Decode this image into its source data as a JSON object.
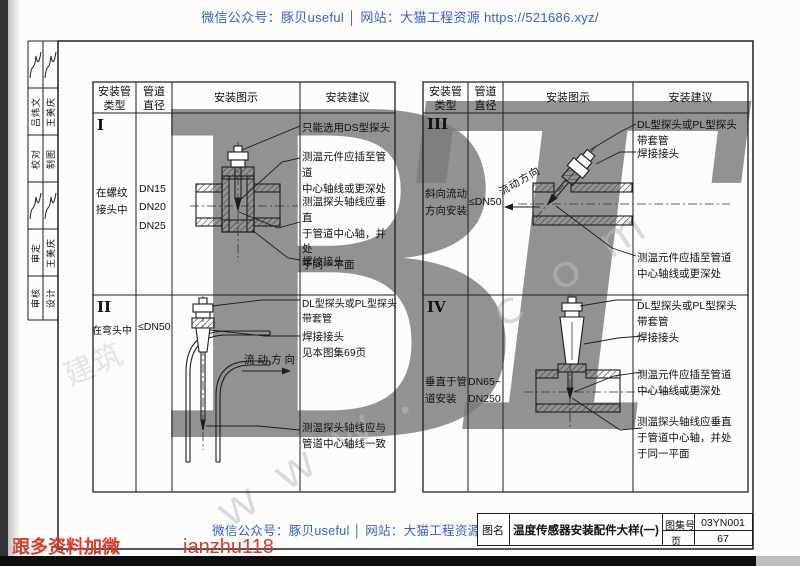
{
  "banners": {
    "top": "微信公众号：豚贝useful │ 网站：大猫工程资源 https://521686.xyz/",
    "bottom": "微信公众号：豚贝useful │ 网站：大猫工程资源",
    "bottom_red_left": "跟多资料加微",
    "bottom_red_handle": "ianzhu118"
  },
  "watermarks": {
    "big_left": "B",
    "big_right": "T",
    "diag_www": "ｗｗｗ．",
    "diag_com": "ｃｏｍ",
    "corner_cn": "建筑"
  },
  "sidebar": {
    "entries": [
      {
        "col1": "吕炜文",
        "col2": "王美庆"
      },
      {
        "col1": "校对",
        "col2": "制图"
      },
      {
        "col1": "审定",
        "col2": "王美庆"
      },
      {
        "col1": "审核",
        "col2": "设计"
      }
    ]
  },
  "tables": {
    "headers": {
      "col1": "安装管\n类型",
      "col2": "管道\n直径",
      "col3": "安装图示",
      "col4": "安装建议"
    },
    "left": {
      "rows": [
        {
          "num": "I",
          "type": "在螺纹\n接头中",
          "diameter": "DN15\nDN20\nDN25",
          "flow_label": "",
          "notes": [
            "只能选用DS型探头",
            "测温元件应插至管道\n中心轴线或更深处",
            "测温探头轴线应垂直\n于管道中心轴，并处\n于同一平面",
            "螺纹接头"
          ]
        },
        {
          "num": "II",
          "type": "在弯头中",
          "diameter": "≤DN50",
          "flow_label": "流动方向",
          "notes": [
            "DL型探头或PL型探头\n带套管",
            "焊接接头\n见本图集69页",
            "测温探头轴线应与\n管道中心轴线一致"
          ]
        }
      ]
    },
    "right": {
      "rows": [
        {
          "num": "III",
          "type": "斜向流动\n方向安装",
          "diameter": "≤DN50",
          "flow_label": "流动方向",
          "notes": [
            "DL型探头或PL型探头\n带套管",
            "焊接接头",
            "测温元件应插至管道\n中心轴线或更深处"
          ]
        },
        {
          "num": "IV",
          "type": "垂直于管\n道安装",
          "diameter": "DN65~\nDN250",
          "flow_label": "",
          "notes": [
            "DL型探头或PL型探头\n带套管",
            "焊接接头",
            "测温元件应插至管道\n中心轴线或更深处",
            "测温探头轴线应垂直\n于管道中心轴，并处\n于同一平面"
          ]
        }
      ]
    }
  },
  "title_block": {
    "name_label": "图名",
    "drawing_name": "温度传感器安装配件大样(一)",
    "atlas_label": "图集号",
    "atlas_no": "03YN001",
    "page_label": "页",
    "page_no": "67"
  },
  "colors": {
    "banner_blue": "#3a5fc5",
    "red": "#d93a2b",
    "watermark_gray": "#7b7b7b"
  }
}
